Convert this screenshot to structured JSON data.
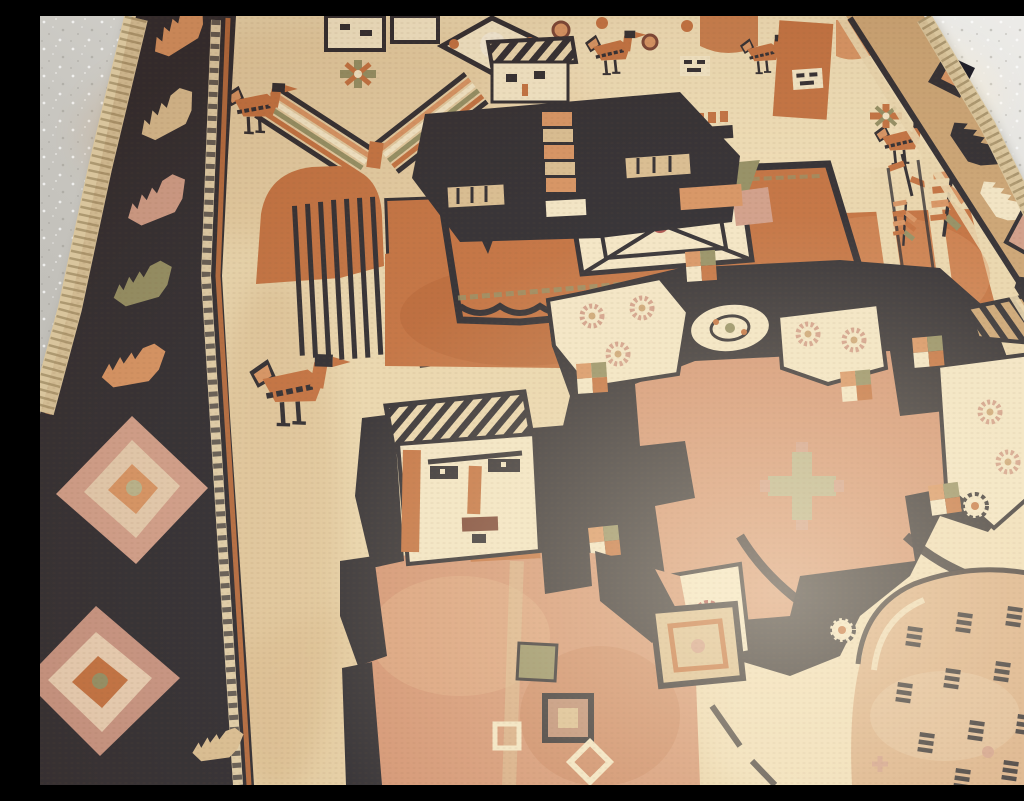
{
  "meta": {
    "type": "photograph",
    "subject": "Antique pictorial tribal rug lying at an angle on a speckled terrazzo floor",
    "alt": "Close angled photograph of a cream-ground hand-knotted tribal rug with rust-orange pictorial motifs: a standing human figure with a woven face, a horse with an ornate saddle cloth and dark-clad rider, birds, a chevron tree, a geometric lattice of cream medallions with rosettes, a round dashed medallion, and a dark serrated-leaf border band, resting on a grey speckled floor visible at the top corners."
  },
  "scene": {
    "floor": {
      "label": "terrazzo floor",
      "description": "light grey terrazzo floor with fine white and dark speckles, brighter toward the top right"
    },
    "rug": {
      "label": "pictorial tribal rug",
      "description": "cream wool field with rust, navy, olive and pink pictorial motifs, photographed at a steep angle"
    },
    "elements": [
      {
        "name": "left-border-band",
        "description": "dark navy border band with diagonal serrated leaves in orange, cream and pink, plus two large pink diamond medallions"
      },
      {
        "name": "right-border-band",
        "description": "tan border band with navy diamond and leaf ornaments along the top right edge"
      },
      {
        "name": "fringe",
        "description": "knotted cream selvage edge along the rug sides"
      },
      {
        "name": "chevron-tree",
        "description": "herringbone chevron tree motif with striped arms"
      },
      {
        "name": "birds",
        "description": "six small stylised orange birds with dark heads and legs"
      },
      {
        "name": "hill-and-ladder",
        "description": "orange dome over a block of thin dark stripes"
      },
      {
        "name": "rider-figure",
        "description": "small square woven face with striped cap above a dark ornamented torso"
      },
      {
        "name": "horse-figure",
        "description": "large rust-orange horse body with crenellated mane comb, cream leg stripes and window marks"
      },
      {
        "name": "saddle-cloth",
        "description": "ornate orange saddle panel with central cream lattice diamond, scalloped edge, green triangle and pink patch"
      },
      {
        "name": "person-figure",
        "description": "large standing figure with cream face, striped hat, dark hair, orange nose and salmon body with amulet squares"
      },
      {
        "name": "medallion-network",
        "description": "navy lattice joining cream shield panels filled with pink rosettes around a stepped orange cross with pale sage blossom"
      },
      {
        "name": "checkerboards",
        "description": "small rust, olive and cream checker squares at lattice joints"
      },
      {
        "name": "amulet-panel",
        "description": "square cream panel with rust inner frame and pink centre"
      },
      {
        "name": "turtle-medallion",
        "description": "large round peach medallion filled with rows of short navy dashes"
      },
      {
        "name": "fern-leaves",
        "description": "small rust fern leaf sprays near the right border"
      },
      {
        "name": "hatched-roof",
        "description": "diagonally hatched triangle near the right edge"
      },
      {
        "name": "top-fragments",
        "description": "partial diamond medallion with white disc and rust rosettes cut by the top edge"
      }
    ]
  },
  "colors": {
    "floor": "#c6c3bd",
    "floorLight": "#edece9",
    "floorDark": "#a9a69f",
    "cream": "#ead7b0",
    "creamL": "#f4e8ca",
    "creamD": "#d9bd92",
    "tan": "#c9a172",
    "rust": "#c06a3a",
    "rustL": "#d68f5f",
    "rustD": "#a2512a",
    "salmon": "#d29071",
    "navy": "#201f29",
    "olive": "#8d8a60",
    "sage": "#b5b08a",
    "pink": "#cf9a88",
    "rose": "#a84848",
    "maroon": "#71392d",
    "fringe": "#d9c59d"
  }
}
